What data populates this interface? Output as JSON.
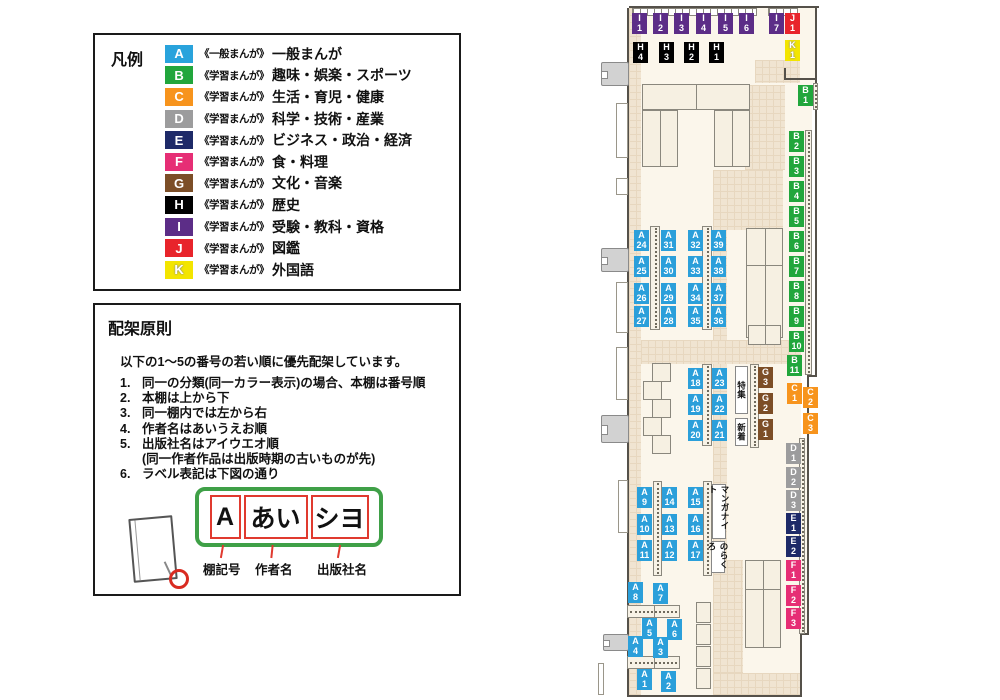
{
  "legend": {
    "title": "凡例",
    "items": [
      {
        "code": "A",
        "color": "#29A3DC",
        "prefix": "《一般まんが》",
        "label": "一般まんが"
      },
      {
        "code": "B",
        "color": "#21A63C",
        "prefix": "《学習まんが》",
        "label": "趣味・娯楽・スポーツ"
      },
      {
        "code": "C",
        "color": "#F7941D",
        "prefix": "《学習まんが》",
        "label": "生活・育児・健康"
      },
      {
        "code": "D",
        "color": "#9C9C9D",
        "prefix": "《学習まんが》",
        "label": "科学・技術・産業"
      },
      {
        "code": "E",
        "color": "#1E2A68",
        "prefix": "《学習まんが》",
        "label": "ビジネス・政治・経済"
      },
      {
        "code": "F",
        "color": "#E62E75",
        "prefix": "《学習まんが》",
        "label": "食・料理"
      },
      {
        "code": "G",
        "color": "#7C4E27",
        "prefix": "《学習まんが》",
        "label": "文化・音楽"
      },
      {
        "code": "H",
        "color": "#000000",
        "prefix": "《学習まんが》",
        "label": "歴史"
      },
      {
        "code": "I",
        "color": "#5C2D87",
        "prefix": "《学習まんが》",
        "label": "受験・教科・資格"
      },
      {
        "code": "J",
        "color": "#E8242B",
        "prefix": "《学習まんが》",
        "label": "図鑑"
      },
      {
        "code": "K",
        "color": "#F3E500",
        "prefix": "《学習まんが》",
        "label": "外国語",
        "light": true
      }
    ]
  },
  "principles": {
    "title": "配架原則",
    "intro": "以下の1〜5の番号の若い順に優先配架しています。",
    "rules": [
      {
        "num": "1.",
        "text": "同一の分類(同一カラー表示)の場合、本棚は番号順"
      },
      {
        "num": "2.",
        "text": "本棚は上から下"
      },
      {
        "num": "3.",
        "text": "同一棚内では左から右"
      },
      {
        "num": "4.",
        "text": "作者名はあいうえお順"
      },
      {
        "num": "5.",
        "text": "出版社名はアイウエオ順",
        "note": "(同一作者作品は出版時期の古いものが先)"
      },
      {
        "num": "6.",
        "text": "ラベル表記は下図の通り"
      }
    ],
    "label_example": {
      "boxes": [
        "A",
        "あい",
        "シヨ"
      ],
      "captions": [
        "棚記号",
        "作者名",
        "出版社名"
      ]
    }
  },
  "map": {
    "category_colors": {
      "A": "#2B9FDA",
      "B": "#21A63C",
      "C": "#F7941D",
      "D": "#9C9C9D",
      "E": "#1E2A68",
      "F": "#E62E75",
      "G": "#7C4E27",
      "H": "#000000",
      "I": "#5C2D87",
      "J": "#E8242B",
      "K": "#F3E500"
    },
    "shelf_labels": [
      {
        "id": "I1",
        "cat": "I",
        "num": "1",
        "x": 36,
        "y": 13
      },
      {
        "id": "I2",
        "cat": "I",
        "num": "2",
        "x": 57,
        "y": 13
      },
      {
        "id": "I3",
        "cat": "I",
        "num": "3",
        "x": 78,
        "y": 13
      },
      {
        "id": "I4",
        "cat": "I",
        "num": "4",
        "x": 100,
        "y": 13
      },
      {
        "id": "I5",
        "cat": "I",
        "num": "5",
        "x": 122,
        "y": 13
      },
      {
        "id": "I6",
        "cat": "I",
        "num": "6",
        "x": 143,
        "y": 13
      },
      {
        "id": "I7",
        "cat": "I",
        "num": "7",
        "x": 173,
        "y": 13
      },
      {
        "id": "J1",
        "cat": "J",
        "num": "1",
        "x": 189,
        "y": 13
      },
      {
        "id": "K1",
        "cat": "K",
        "num": "1",
        "x": 189,
        "y": 40
      },
      {
        "id": "H4",
        "cat": "H",
        "num": "4",
        "x": 37,
        "y": 42
      },
      {
        "id": "H3",
        "cat": "H",
        "num": "3",
        "x": 63,
        "y": 42
      },
      {
        "id": "H2",
        "cat": "H",
        "num": "2",
        "x": 88,
        "y": 42
      },
      {
        "id": "H1",
        "cat": "H",
        "num": "1",
        "x": 113,
        "y": 42
      },
      {
        "id": "B1",
        "cat": "B",
        "num": "1",
        "x": 202,
        "y": 85
      },
      {
        "id": "B2",
        "cat": "B",
        "num": "2",
        "x": 193,
        "y": 131
      },
      {
        "id": "B3",
        "cat": "B",
        "num": "3",
        "x": 193,
        "y": 156
      },
      {
        "id": "B4",
        "cat": "B",
        "num": "4",
        "x": 193,
        "y": 181
      },
      {
        "id": "B5",
        "cat": "B",
        "num": "5",
        "x": 193,
        "y": 206
      },
      {
        "id": "B6",
        "cat": "B",
        "num": "6",
        "x": 193,
        "y": 231
      },
      {
        "id": "B7",
        "cat": "B",
        "num": "7",
        "x": 193,
        "y": 256
      },
      {
        "id": "B8",
        "cat": "B",
        "num": "8",
        "x": 193,
        "y": 281
      },
      {
        "id": "B9",
        "cat": "B",
        "num": "9",
        "x": 193,
        "y": 306
      },
      {
        "id": "B10",
        "cat": "B",
        "num": "10",
        "x": 193,
        "y": 331
      },
      {
        "id": "B11",
        "cat": "B",
        "num": "11",
        "x": 191,
        "y": 355
      },
      {
        "id": "C1",
        "cat": "C",
        "num": "1",
        "x": 191,
        "y": 383
      },
      {
        "id": "C2",
        "cat": "C",
        "num": "2",
        "x": 207,
        "y": 387
      },
      {
        "id": "C3",
        "cat": "C",
        "num": "3",
        "x": 207,
        "y": 413
      },
      {
        "id": "D1",
        "cat": "D",
        "num": "1",
        "x": 190,
        "y": 443
      },
      {
        "id": "D2",
        "cat": "D",
        "num": "2",
        "x": 190,
        "y": 467
      },
      {
        "id": "D3",
        "cat": "D",
        "num": "3",
        "x": 190,
        "y": 490
      },
      {
        "id": "E1",
        "cat": "E",
        "num": "1",
        "x": 190,
        "y": 513
      },
      {
        "id": "E2",
        "cat": "E",
        "num": "2",
        "x": 190,
        "y": 536
      },
      {
        "id": "F1",
        "cat": "F",
        "num": "1",
        "x": 190,
        "y": 560
      },
      {
        "id": "F2",
        "cat": "F",
        "num": "2",
        "x": 190,
        "y": 585
      },
      {
        "id": "F3",
        "cat": "F",
        "num": "3",
        "x": 190,
        "y": 608
      },
      {
        "id": "G3",
        "cat": "G",
        "num": "3",
        "x": 162,
        "y": 367
      },
      {
        "id": "G2",
        "cat": "G",
        "num": "2",
        "x": 162,
        "y": 393
      },
      {
        "id": "G1",
        "cat": "G",
        "num": "1",
        "x": 162,
        "y": 419
      },
      {
        "id": "A24",
        "cat": "A",
        "num": "24",
        "x": 38,
        "y": 230
      },
      {
        "id": "A31",
        "cat": "A",
        "num": "31",
        "x": 65,
        "y": 230
      },
      {
        "id": "A25",
        "cat": "A",
        "num": "25",
        "x": 38,
        "y": 256
      },
      {
        "id": "A30",
        "cat": "A",
        "num": "30",
        "x": 65,
        "y": 256
      },
      {
        "id": "A26",
        "cat": "A",
        "num": "26",
        "x": 38,
        "y": 283
      },
      {
        "id": "A29",
        "cat": "A",
        "num": "29",
        "x": 65,
        "y": 283
      },
      {
        "id": "A27",
        "cat": "A",
        "num": "27",
        "x": 38,
        "y": 306
      },
      {
        "id": "A28",
        "cat": "A",
        "num": "28",
        "x": 65,
        "y": 306
      },
      {
        "id": "A32",
        "cat": "A",
        "num": "32",
        "x": 92,
        "y": 230
      },
      {
        "id": "A39",
        "cat": "A",
        "num": "39",
        "x": 115,
        "y": 230
      },
      {
        "id": "A33",
        "cat": "A",
        "num": "33",
        "x": 92,
        "y": 256
      },
      {
        "id": "A38",
        "cat": "A",
        "num": "38",
        "x": 115,
        "y": 256
      },
      {
        "id": "A34",
        "cat": "A",
        "num": "34",
        "x": 92,
        "y": 283
      },
      {
        "id": "A37",
        "cat": "A",
        "num": "37",
        "x": 115,
        "y": 283
      },
      {
        "id": "A35",
        "cat": "A",
        "num": "35",
        "x": 92,
        "y": 306
      },
      {
        "id": "A36",
        "cat": "A",
        "num": "36",
        "x": 115,
        "y": 306
      },
      {
        "id": "A18",
        "cat": "A",
        "num": "18",
        "x": 92,
        "y": 368
      },
      {
        "id": "A23",
        "cat": "A",
        "num": "23",
        "x": 116,
        "y": 368
      },
      {
        "id": "A19",
        "cat": "A",
        "num": "19",
        "x": 92,
        "y": 394
      },
      {
        "id": "A22",
        "cat": "A",
        "num": "22",
        "x": 116,
        "y": 394
      },
      {
        "id": "A20",
        "cat": "A",
        "num": "20",
        "x": 92,
        "y": 420
      },
      {
        "id": "A21",
        "cat": "A",
        "num": "21",
        "x": 116,
        "y": 420
      },
      {
        "id": "A9",
        "cat": "A",
        "num": "9",
        "x": 41,
        "y": 487
      },
      {
        "id": "A14",
        "cat": "A",
        "num": "14",
        "x": 66,
        "y": 487
      },
      {
        "id": "A10",
        "cat": "A",
        "num": "10",
        "x": 41,
        "y": 514
      },
      {
        "id": "A13",
        "cat": "A",
        "num": "13",
        "x": 66,
        "y": 514
      },
      {
        "id": "A11",
        "cat": "A",
        "num": "11",
        "x": 41,
        "y": 540
      },
      {
        "id": "A12",
        "cat": "A",
        "num": "12",
        "x": 66,
        "y": 540
      },
      {
        "id": "A15",
        "cat": "A",
        "num": "15",
        "x": 92,
        "y": 487
      },
      {
        "id": "A16",
        "cat": "A",
        "num": "16",
        "x": 92,
        "y": 514
      },
      {
        "id": "A17",
        "cat": "A",
        "num": "17",
        "x": 92,
        "y": 540
      },
      {
        "id": "A8",
        "cat": "A",
        "num": "8",
        "x": 32,
        "y": 582
      },
      {
        "id": "A7",
        "cat": "A",
        "num": "7",
        "x": 57,
        "y": 583
      },
      {
        "id": "A5",
        "cat": "A",
        "num": "5",
        "x": 46,
        "y": 618
      },
      {
        "id": "A6",
        "cat": "A",
        "num": "6",
        "x": 71,
        "y": 619
      },
      {
        "id": "A4",
        "cat": "A",
        "num": "4",
        "x": 32,
        "y": 636
      },
      {
        "id": "A3",
        "cat": "A",
        "num": "3",
        "x": 57,
        "y": 637
      },
      {
        "id": "A1",
        "cat": "A",
        "num": "1",
        "x": 41,
        "y": 669
      },
      {
        "id": "A2",
        "cat": "A",
        "num": "2",
        "x": 65,
        "y": 671
      }
    ],
    "area_labels": [
      {
        "id": "tokushu",
        "text": "特集",
        "x": 139,
        "y": 366,
        "w": 13,
        "h": 48
      },
      {
        "id": "shinchaku",
        "text": "新着",
        "x": 139,
        "y": 418,
        "w": 13,
        "h": 28
      },
      {
        "id": "manga-night",
        "text": "マンガナイト",
        "x": 116,
        "y": 484,
        "w": 14,
        "h": 55
      },
      {
        "id": "norakuro",
        "text": "のらくろ",
        "x": 115,
        "y": 541,
        "w": 14,
        "h": 32
      }
    ]
  }
}
